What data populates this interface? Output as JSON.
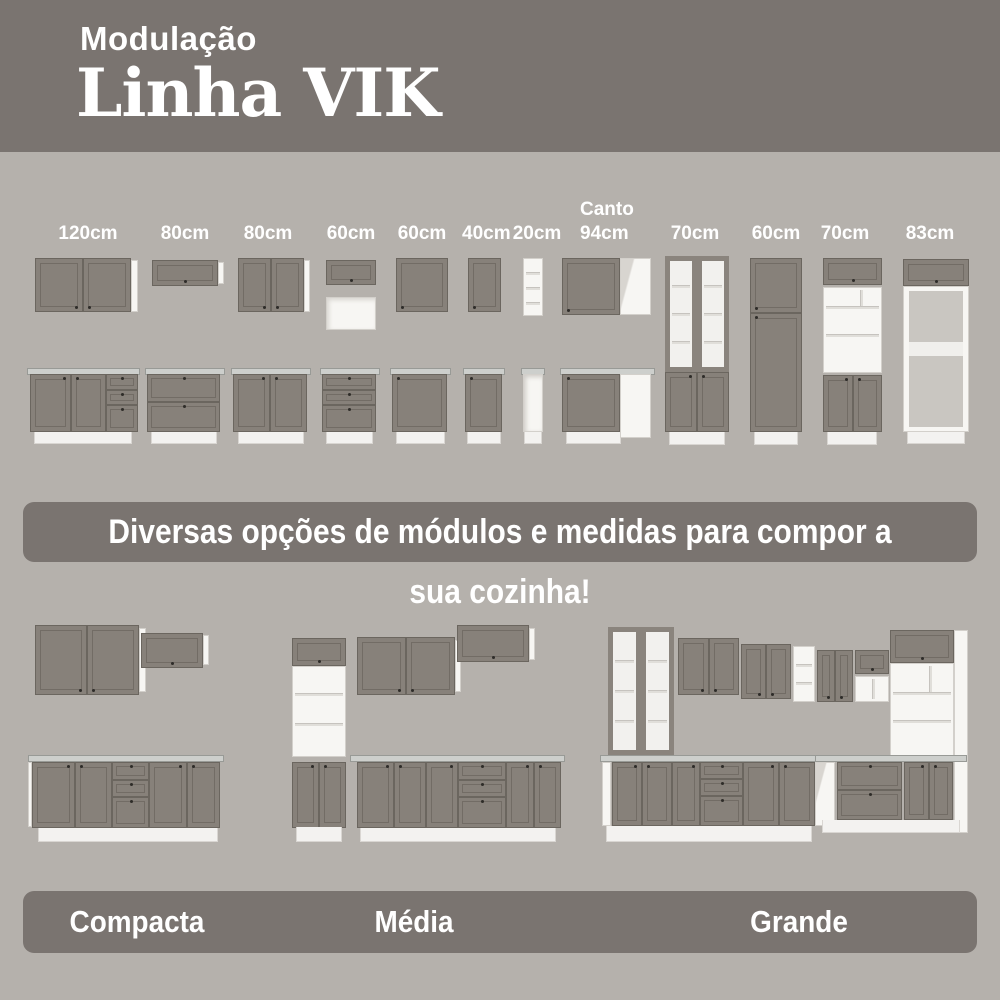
{
  "header": {
    "kicker": "Modulação",
    "title": "Linha VIK"
  },
  "modules": {
    "wall_sizes": [
      "120cm",
      "80cm",
      "80cm",
      "60cm",
      "60cm",
      "40cm",
      "20cm"
    ],
    "canto": {
      "line1": "Canto",
      "line2": "94cm"
    },
    "tall_sizes": [
      "70cm",
      "60cm",
      "70cm",
      "83cm"
    ]
  },
  "banner": {
    "text": "Diversas opções de módulos e medidas para compor a sua cozinha!"
  },
  "kitchens": {
    "labels": [
      "Compacta",
      "Média",
      "Grande"
    ]
  },
  "colors": {
    "banner_bg": "#7a7470",
    "page_bg": "#b5b1ac",
    "door": "#87817a",
    "carcass_white": "#f7f6f3"
  }
}
